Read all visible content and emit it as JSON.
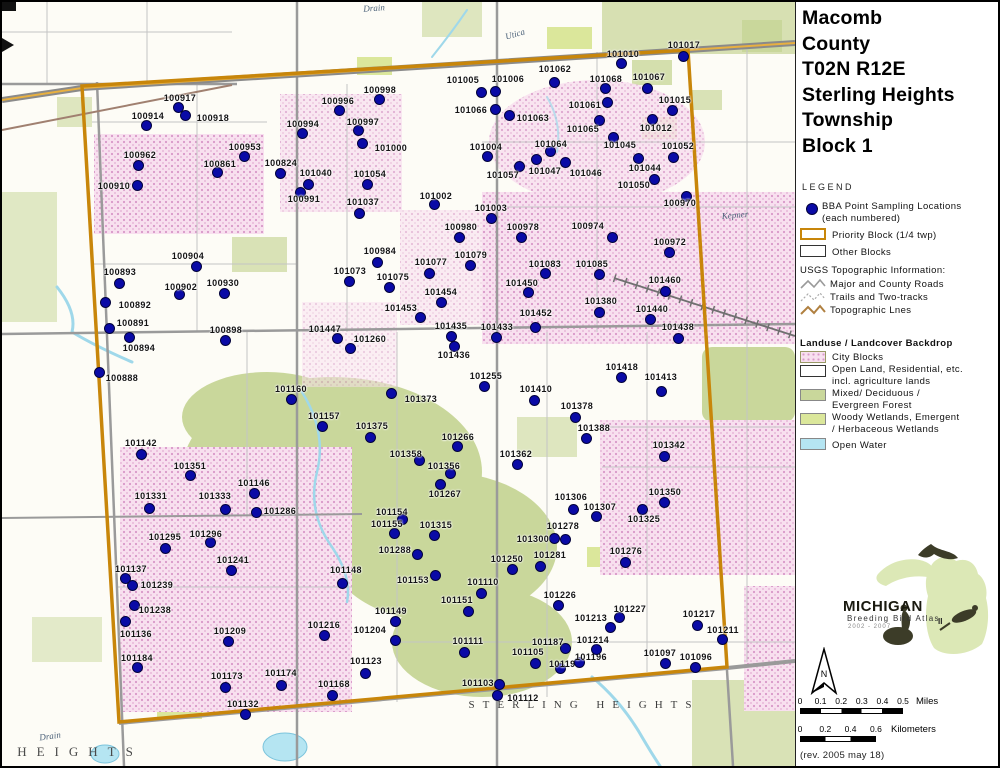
{
  "title": {
    "lines": [
      "Macomb",
      "County",
      "T02N R12E",
      "Sterling Heights",
      "Township",
      "Block 1"
    ]
  },
  "legend": {
    "heading": "LEGEND",
    "bba_line1": "BBA Point Sampling Locations",
    "bba_line2": "(each numbered)",
    "priority_label": "Priority Block (1/4 twp)",
    "other_label": "Other Blocks",
    "usgs_heading": "USGS Topographic Information:",
    "usgs_items": [
      "Major and County Roads",
      "Trails and Two-tracks",
      "Topographic Lnes"
    ],
    "landuse_heading": "Landuse / Landcover Backdrop",
    "landuse_items": [
      {
        "label": "City Blocks",
        "label2": ""
      },
      {
        "label": "Open Land, Residential, etc.",
        "label2": "incl. agriculture lands"
      },
      {
        "label": "Mixed/ Deciduous /",
        "label2": "Evergreen Forest"
      },
      {
        "label": "Woody Wetlands, Emergent",
        "label2": "/ Herbaceous Wetlands"
      },
      {
        "label": "Open Water",
        "label2": ""
      }
    ]
  },
  "logo": {
    "name": "MICHIGAN",
    "subtitle": "Breeding Bird Atlas",
    "years": "2002 - 2007",
    "numeral": "II"
  },
  "north_label": "N",
  "scalebars": {
    "miles": {
      "ticks": [
        "0",
        "0.1",
        "0.2",
        "0.3",
        "0.4",
        "0.5"
      ],
      "unit": "Miles"
    },
    "km": {
      "ticks": [
        "0",
        "0.2",
        "0.4",
        "0.6"
      ],
      "unit": "Kilometers"
    }
  },
  "revision": "(rev. 2005 may 18)",
  "colors": {
    "point_fill": "#0a0aa6",
    "point_outline": "#02023c",
    "priority_block": "#c8860a",
    "city_block_fill": "#f8e0ef",
    "forest": "#c9d79b",
    "wetland": "#dbe79b",
    "water": "#b5e5f2",
    "road_gray": "#9a9a9a"
  },
  "map_texts": [
    {
      "text": "Drain",
      "x": 372,
      "y": 6,
      "cls": "hydro",
      "rot": -4
    },
    {
      "text": "Utica",
      "x": 513,
      "y": 32,
      "cls": "hydro",
      "rot": -16
    },
    {
      "text": "Kepner",
      "x": 733,
      "y": 213,
      "cls": "hydro",
      "rot": -5
    },
    {
      "text": "Drain",
      "x": 48,
      "y": 734,
      "cls": "hydro",
      "rot": -8
    },
    {
      "text": "STERLING HEIGHTS",
      "x": 582,
      "y": 703,
      "cls": "city",
      "rot": 0
    },
    {
      "text": "HEIGHTS",
      "x": 78,
      "y": 750,
      "cls": "cityBig",
      "rot": 0
    }
  ],
  "points_format": [
    "label",
    "dot_x",
    "dot_y",
    "label_x",
    "label_y"
  ],
  "points": [
    [
      "100917",
      176,
      105,
      178,
      96
    ],
    [
      "100918",
      183,
      113,
      211,
      116
    ],
    [
      "100914",
      144,
      123,
      146,
      114
    ],
    [
      "100962",
      136,
      163,
      138,
      153
    ],
    [
      "100910",
      135,
      183,
      112,
      184
    ],
    [
      "100953",
      242,
      154,
      243,
      145
    ],
    [
      "100861",
      215,
      170,
      218,
      162
    ],
    [
      "100824",
      278,
      171,
      279,
      161
    ],
    [
      "101040",
      306,
      182,
      314,
      171
    ],
    [
      "101054",
      365,
      182,
      368,
      172
    ],
    [
      "100994",
      300,
      131,
      301,
      122
    ],
    [
      "100996",
      337,
      108,
      336,
      99
    ],
    [
      "100998",
      377,
      97,
      378,
      88
    ],
    [
      "100997",
      356,
      128,
      361,
      120
    ],
    [
      "101000",
      360,
      141,
      389,
      146
    ],
    [
      "100991",
      298,
      190,
      302,
      197
    ],
    [
      "101037",
      357,
      211,
      361,
      200
    ],
    [
      "100984",
      375,
      260,
      378,
      249
    ],
    [
      "101073",
      347,
      279,
      348,
      269
    ],
    [
      "101075",
      387,
      285,
      391,
      275
    ],
    [
      "100904",
      194,
      264,
      186,
      254
    ],
    [
      "100893",
      117,
      281,
      118,
      270
    ],
    [
      "100902",
      177,
      292,
      179,
      285
    ],
    [
      "100930",
      222,
      291,
      221,
      281
    ],
    [
      "100892",
      103,
      300,
      133,
      303
    ],
    [
      "100891",
      107,
      326,
      131,
      321
    ],
    [
      "100894",
      127,
      335,
      137,
      346
    ],
    [
      "100888",
      97,
      370,
      120,
      376
    ],
    [
      "100898",
      223,
      338,
      224,
      328
    ],
    [
      "101447",
      335,
      336,
      323,
      327
    ],
    [
      "101260",
      348,
      346,
      368,
      337
    ],
    [
      "101002",
      432,
      202,
      434,
      194
    ],
    [
      "101003",
      489,
      216,
      489,
      206
    ],
    [
      "100980",
      457,
      235,
      459,
      225
    ],
    [
      "100978",
      519,
      235,
      521,
      225
    ],
    [
      "101079",
      468,
      263,
      469,
      253
    ],
    [
      "101077",
      427,
      271,
      429,
      260
    ],
    [
      "101083",
      543,
      271,
      543,
      262
    ],
    [
      "101085",
      597,
      272,
      590,
      262
    ],
    [
      "101450",
      526,
      290,
      520,
      281
    ],
    [
      "101454",
      439,
      300,
      439,
      290
    ],
    [
      "101453",
      418,
      315,
      399,
      306
    ],
    [
      "101452",
      533,
      325,
      534,
      311
    ],
    [
      "101435",
      449,
      334,
      449,
      324
    ],
    [
      "101433",
      494,
      335,
      495,
      325
    ],
    [
      "101436",
      452,
      344,
      452,
      353
    ],
    [
      "101255",
      482,
      384,
      484,
      374
    ],
    [
      "100970",
      684,
      194,
      678,
      201
    ],
    [
      "100974",
      610,
      235,
      586,
      224
    ],
    [
      "100972",
      667,
      250,
      668,
      240
    ],
    [
      "101460",
      663,
      289,
      663,
      278
    ],
    [
      "101380",
      597,
      310,
      599,
      299
    ],
    [
      "101440",
      648,
      317,
      650,
      307
    ],
    [
      "101438",
      676,
      336,
      676,
      325
    ],
    [
      "101418",
      619,
      375,
      620,
      365
    ],
    [
      "101413",
      659,
      389,
      659,
      375
    ],
    [
      "101342",
      662,
      454,
      667,
      443
    ],
    [
      "101350",
      662,
      500,
      663,
      490
    ],
    [
      "101307",
      594,
      514,
      598,
      505
    ],
    [
      "101306",
      571,
      507,
      569,
      495
    ],
    [
      "101325",
      640,
      507,
      642,
      517
    ],
    [
      "101276",
      623,
      560,
      624,
      549
    ],
    [
      "101278",
      563,
      537,
      561,
      524
    ],
    [
      "101300",
      552,
      536,
      531,
      537
    ],
    [
      "101281",
      538,
      564,
      548,
      553
    ],
    [
      "101250",
      510,
      567,
      505,
      557
    ],
    [
      "101362",
      515,
      462,
      514,
      452
    ],
    [
      "101358",
      417,
      458,
      404,
      452
    ],
    [
      "101356",
      448,
      471,
      442,
      464
    ],
    [
      "101267",
      438,
      482,
      443,
      492
    ],
    [
      "101266",
      455,
      444,
      456,
      435
    ],
    [
      "101373",
      389,
      391,
      419,
      397
    ],
    [
      "101375",
      368,
      435,
      370,
      424
    ],
    [
      "101157",
      320,
      424,
      322,
      414
    ],
    [
      "101160",
      289,
      397,
      289,
      387
    ],
    [
      "101410",
      532,
      398,
      534,
      387
    ],
    [
      "101378",
      573,
      415,
      575,
      404
    ],
    [
      "101388",
      584,
      436,
      592,
      426
    ],
    [
      "101154",
      400,
      517,
      390,
      510
    ],
    [
      "101155",
      392,
      531,
      385,
      522
    ],
    [
      "101315",
      432,
      533,
      434,
      523
    ],
    [
      "101288",
      415,
      552,
      393,
      548
    ],
    [
      "101148",
      340,
      581,
      344,
      568
    ],
    [
      "101153",
      433,
      573,
      411,
      578
    ],
    [
      "101149",
      393,
      619,
      389,
      609
    ],
    [
      "101209",
      226,
      639,
      228,
      629
    ],
    [
      "101216",
      322,
      633,
      322,
      623
    ],
    [
      "101204",
      393,
      638,
      368,
      628
    ],
    [
      "101123",
      363,
      671,
      364,
      659
    ],
    [
      "101174",
      279,
      683,
      279,
      671
    ],
    [
      "101173",
      223,
      685,
      225,
      674
    ],
    [
      "101168",
      330,
      693,
      332,
      682
    ],
    [
      "101132",
      243,
      712,
      241,
      702
    ],
    [
      "101239",
      130,
      583,
      155,
      583
    ],
    [
      "101238",
      132,
      603,
      153,
      608
    ],
    [
      "101136",
      123,
      619,
      134,
      632
    ],
    [
      "101184",
      135,
      665,
      135,
      656
    ],
    [
      "101137",
      123,
      576,
      129,
      567
    ],
    [
      "101295",
      163,
      546,
      163,
      535
    ],
    [
      "101296",
      208,
      540,
      204,
      532
    ],
    [
      "101241",
      229,
      568,
      231,
      558
    ],
    [
      "101331",
      147,
      506,
      149,
      494
    ],
    [
      "101333",
      223,
      507,
      213,
      494
    ],
    [
      "101146",
      252,
      491,
      252,
      481
    ],
    [
      "101286",
      254,
      510,
      278,
      509
    ],
    [
      "101351",
      188,
      473,
      188,
      464
    ],
    [
      "101142",
      139,
      452,
      139,
      441
    ],
    [
      "101110",
      479,
      591,
      481,
      580
    ],
    [
      "101151",
      466,
      609,
      455,
      598
    ],
    [
      "101226",
      556,
      603,
      558,
      593
    ],
    [
      "101111",
      462,
      650,
      466,
      639
    ],
    [
      "101105",
      533,
      661,
      526,
      650
    ],
    [
      "101187",
      563,
      646,
      546,
      640
    ],
    [
      "101193",
      558,
      666,
      563,
      662
    ],
    [
      "101196",
      577,
      660,
      589,
      655
    ],
    [
      "101214",
      594,
      647,
      591,
      638
    ],
    [
      "101213",
      608,
      625,
      589,
      616
    ],
    [
      "101227",
      617,
      615,
      628,
      607
    ],
    [
      "101217",
      695,
      623,
      697,
      612
    ],
    [
      "101211",
      720,
      637,
      721,
      628
    ],
    [
      "101097",
      663,
      661,
      658,
      651
    ],
    [
      "101096",
      693,
      665,
      694,
      655
    ],
    [
      "101103",
      497,
      682,
      476,
      681
    ],
    [
      "101112",
      495,
      693,
      521,
      696
    ],
    [
      "101010",
      619,
      61,
      621,
      52
    ],
    [
      "101017",
      681,
      54,
      682,
      43
    ],
    [
      "101068",
      603,
      86,
      604,
      77
    ],
    [
      "101067",
      645,
      86,
      647,
      75
    ],
    [
      "101061",
      605,
      100,
      583,
      103
    ],
    [
      "101015",
      670,
      108,
      673,
      98
    ],
    [
      "101012",
      650,
      117,
      654,
      126
    ],
    [
      "101065",
      597,
      118,
      581,
      127
    ],
    [
      "101045",
      611,
      135,
      618,
      143
    ],
    [
      "101052",
      671,
      155,
      676,
      144
    ],
    [
      "101044",
      636,
      156,
      643,
      166
    ],
    [
      "101046",
      563,
      160,
      584,
      171
    ],
    [
      "101050",
      652,
      177,
      632,
      183
    ],
    [
      "101062",
      552,
      80,
      553,
      67
    ],
    [
      "101063",
      507,
      113,
      531,
      116
    ],
    [
      "101066",
      493,
      107,
      469,
      108
    ],
    [
      "101005",
      479,
      90,
      461,
      78
    ],
    [
      "101006",
      493,
      89,
      506,
      77
    ],
    [
      "101064",
      548,
      149,
      549,
      142
    ],
    [
      "101004",
      485,
      154,
      484,
      145
    ],
    [
      "101057",
      517,
      164,
      501,
      173
    ],
    [
      "101047",
      534,
      157,
      543,
      169
    ]
  ]
}
